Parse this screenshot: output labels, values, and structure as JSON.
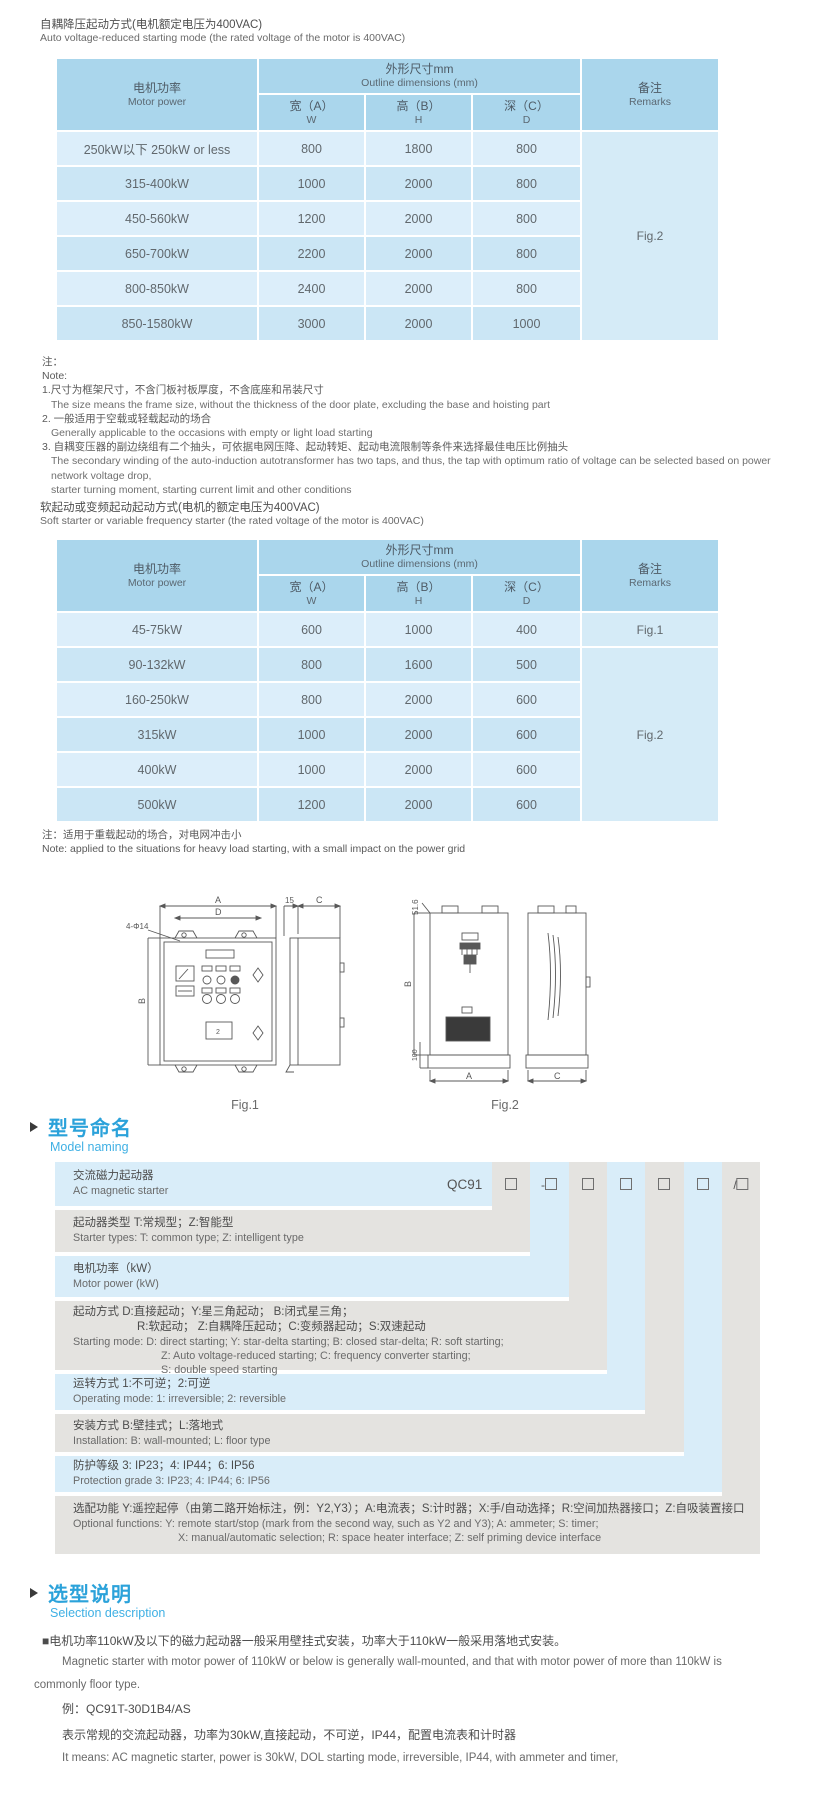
{
  "colors": {
    "header_blue": "#aad6ec",
    "row_light": "#dceefa",
    "row_dark": "#cbe6f5",
    "naming_gray": "#e4e3e0",
    "naming_blue": "#d9edf9",
    "heading_blue": "#2ba2da",
    "louver_dark": "#3a3a3a"
  },
  "section1": {
    "title_zh": "自耦降压起动方式(电机额定电压为400VAC)",
    "title_en": "Auto voltage-reduced starting mode (the rated voltage of the motor is 400VAC)"
  },
  "table_header": {
    "motor_power_zh": "电机功率",
    "motor_power_en": "Motor power",
    "outline_zh": "外形尺寸mm",
    "outline_en": "Outline dimensions (mm)",
    "w_zh": "宽（A）",
    "w_en": "W",
    "h_zh": "高（B）",
    "h_en": "H",
    "d_zh": "深（C）",
    "d_en": "D",
    "remarks_zh": "备注",
    "remarks_en": "Remarks"
  },
  "table1": {
    "rows": [
      {
        "power": "250kW以下 250kW or less",
        "w": "800",
        "h": "1800",
        "d": "800"
      },
      {
        "power": "315-400kW",
        "w": "1000",
        "h": "2000",
        "d": "800"
      },
      {
        "power": "450-560kW",
        "w": "1200",
        "h": "2000",
        "d": "800"
      },
      {
        "power": "650-700kW",
        "w": "2200",
        "h": "2000",
        "d": "800"
      },
      {
        "power": "800-850kW",
        "w": "2400",
        "h": "2000",
        "d": "800"
      },
      {
        "power": "850-1580kW",
        "w": "3000",
        "h": "2000",
        "d": "1000"
      }
    ],
    "remark": "Fig.2"
  },
  "notes1": {
    "zh_label": "注：",
    "en_label": "Note:",
    "item1_zh": "1.尺寸为框架尺寸，不含门板衬板厚度，不含底座和吊装尺寸",
    "item1_en": "The size means the frame size, without the thickness of the door plate, excluding the base and hoisting part",
    "item2_zh": "2. 一般适用于空载或轻载起动的场合",
    "item2_en": "Generally applicable to the occasions with empty or light load starting",
    "item3_zh": "3. 自耦变压器的副边绕组有二个抽头，可依据电网压降、起动转矩、起动电流限制等条件来选择最佳电压比例抽头",
    "item3_en": "The secondary winding of the auto-induction autotransformer has two taps, and thus, the tap with optimum ratio of voltage can be selected based on power network voltage drop,",
    "item3_en2": "starter turning moment, starting current limit and other conditions"
  },
  "section2": {
    "title_zh": "软起动或变频起动起动方式(电机的额定电压为400VAC)",
    "title_en": "Soft starter or variable frequency starter (the rated voltage of the motor is 400VAC)"
  },
  "table2": {
    "rows": [
      {
        "power": "45-75kW",
        "w": "600",
        "h": "1000",
        "d": "400"
      },
      {
        "power": "90-132kW",
        "w": "800",
        "h": "1600",
        "d": "500"
      },
      {
        "power": "160-250kW",
        "w": "800",
        "h": "2000",
        "d": "600"
      },
      {
        "power": "315kW",
        "w": "1000",
        "h": "2000",
        "d": "600"
      },
      {
        "power": "400kW",
        "w": "1000",
        "h": "2000",
        "d": "600"
      },
      {
        "power": "500kW",
        "w": "1200",
        "h": "2000",
        "d": "600"
      }
    ],
    "remark_row1": "Fig.1",
    "remark_rest": "Fig.2"
  },
  "notes2": {
    "zh": "注：适用于重载起动的场合，对电网冲击小",
    "en": "Note: applied to the situations for heavy load starting, with a small impact on the power grid"
  },
  "figures": {
    "fig1_caption": "Fig.1",
    "fig2_caption": "Fig.2",
    "fig1_labels": {
      "a": "A",
      "d": "D",
      "holes": "4-Φ14",
      "b": "B",
      "s15": "15",
      "c": "C",
      "plate": "2"
    },
    "fig2_labels": {
      "top": "51.6",
      "b": "B",
      "h100": "100",
      "a": "A",
      "c": "C"
    }
  },
  "model_naming": {
    "heading_zh": "型号命名",
    "heading_en": "Model naming",
    "base_code": "QC91",
    "box_prefixes": [
      "",
      "-",
      "",
      "",
      "",
      "",
      "/"
    ],
    "rows": [
      {
        "zh": "交流磁力起动器",
        "en": "AC magnetic starter"
      },
      {
        "zh": "起动器类型 T:常规型；Z:智能型",
        "en": "Starter types: T: common type; Z: intelligent type"
      },
      {
        "zh": "电机功率（kW）",
        "en": "Motor power (kW)"
      },
      {
        "zh": "起动方式 D:直接起动；Y:星三角起动；  B:闭式星三角；",
        "zh2": "R:软起动；  Z:自耦降压起动；C:变频器起动；S:双速起动",
        "en": "Starting mode: D: direct starting; Y: star-delta starting; B: closed star-delta; R: soft starting;",
        "en2": "Z: Auto voltage-reduced starting; C: frequency converter starting;",
        "en3": "S: double speed starting"
      },
      {
        "zh": "运转方式 1:不可逆；2:可逆",
        "en": "Operating mode: 1: irreversible; 2: reversible"
      },
      {
        "zh": "安装方式 B:壁挂式；L:落地式",
        "en": "Installation: B: wall-mounted; L: floor type"
      },
      {
        "zh": "防护等级 3: IP23；4: IP44；6: IP56",
        "en": "Protection grade 3: IP23; 4: IP44; 6: IP56"
      },
      {
        "zh": "选配功能 Y:遥控起停（由第二路开始标注，例：Y2,Y3）；A:电流表；S:计时器；X:手/自动选择；R:空间加热器接口；Z:自吸装置接口",
        "en": "Optional functions: Y: remote start/stop (mark from the second way, such as Y2 and Y3); A: ammeter; S: timer;",
        "en2": "X: manual/automatic selection; R: space heater interface; Z: self priming device interface"
      }
    ]
  },
  "selection": {
    "heading_zh": "选型说明",
    "heading_en": "Selection description",
    "p1_zh": "■电机功率110kW及以下的磁力起动器一般采用壁挂式安装，功率大于110kW一般采用落地式安装。",
    "p1_en1": "Magnetic starter with motor power of 110kW or below is generally wall-mounted, and that with motor power of more than 110kW is",
    "p1_en2": "commonly floor type.",
    "example": "例：QC91T-30D1B4/AS",
    "desc_zh": "表示常规的交流起动器，功率为30kW,直接起动，不可逆，IP44，配置电流表和计时器",
    "desc_en": "It means: AC magnetic starter, power is 30kW, DOL starting mode, irreversible, IP44, with ammeter and timer,"
  }
}
